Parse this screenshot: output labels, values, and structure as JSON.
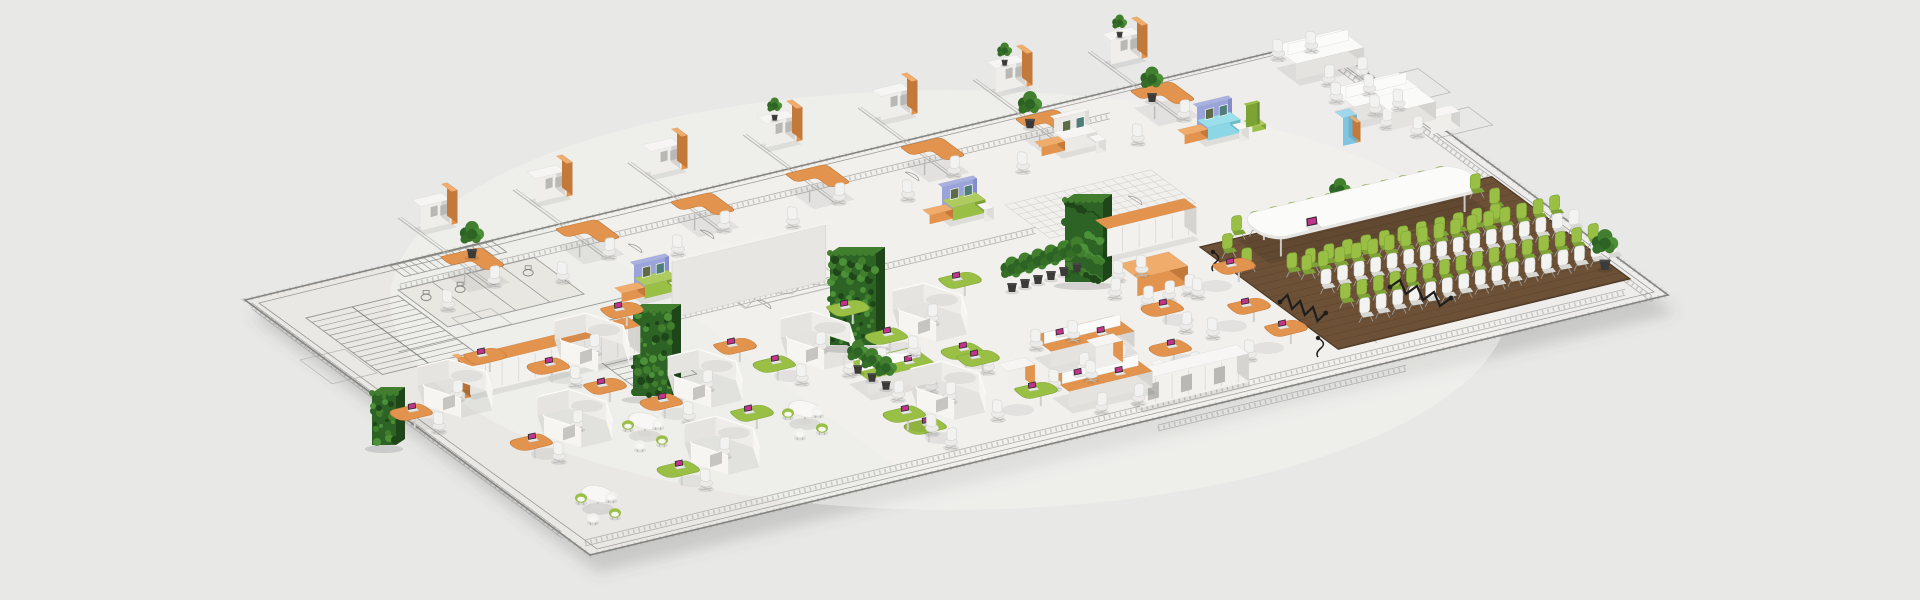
{
  "colors": {
    "bg": "#e8e8e7",
    "floorMain": "#eeedeb",
    "floorWing": "#e9e8e5",
    "centerLight": "#f4f3f0",
    "line": "#9a9a98",
    "lineDark": "#83837f",
    "lineFaint": "#bcbbb8",
    "orange": "#e2934e",
    "orangeLight": "#f0ac6b",
    "orangeDark": "#c3793a",
    "green": "#9abf45",
    "greenLight": "#aecb5f",
    "greenDark": "#7da336",
    "hedge": "#2d6324",
    "hedgeLight": "#417f2e",
    "hedgeDark": "#1e4619",
    "cyan": "#8bd7e5",
    "cyanDark": "#6cbccb",
    "lavender": "#9ba4da",
    "lavenderDark": "#848dc9",
    "wood": "#6d5137",
    "woodLine": "#55402a",
    "woodLight": "#7c5e41",
    "white": "#f5f4f2",
    "whiteFace": "#e4e3e0",
    "whiteSide": "#d5d4d1",
    "chairWhite": "#f2f2f0",
    "chairWhiteDark": "#d8d8d5",
    "screen": "#c2348c",
    "cable": "#1e1e1e",
    "shadow": "rgba(60,60,60,0.12)"
  },
  "areas": {
    "left_wing": "unfurnished-architectural-plan",
    "office_row": "private-offices",
    "bench_area": "open-bench-desks",
    "lounge": "soft-seating-lounge",
    "hex_field": "honeycomb-workstations",
    "conference": "town-hall-conference-area",
    "green_walls": "living-plant-walls"
  },
  "outline": {
    "corners": [
      [
        245,
        300
      ],
      [
        1323,
        40
      ],
      [
        1668,
        295
      ],
      [
        590,
        555
      ]
    ]
  },
  "offices": {
    "count": 7,
    "modules": [
      [
        412,
        224
      ],
      [
        527,
        196
      ],
      [
        642,
        169
      ],
      [
        757,
        141
      ],
      [
        872,
        114
      ],
      [
        987,
        86
      ],
      [
        1102,
        58
      ]
    ],
    "cabinet_plants": [
      3,
      5,
      6
    ],
    "floor_plants": [
      [
        472,
        252
      ],
      [
        1030,
        122
      ]
    ]
  },
  "benches": {
    "white_clusters": [
      [
        1272,
        62
      ],
      [
        1330,
        105
      ]
    ],
    "credenza": [
      1422,
      128
    ],
    "blue_locker": [
      1335,
      140
    ],
    "ne_meeting": [
      1372,
      116
    ]
  },
  "lounges": [
    {
      "x": 630,
      "y": 288,
      "sofa": "green"
    },
    {
      "x": 938,
      "y": 210,
      "sofa": "green"
    },
    {
      "x": 1050,
      "y": 142,
      "sofa": "white"
    },
    {
      "x": 1193,
      "y": 130,
      "sofa": "cyan"
    }
  ],
  "green_walls": [
    [
      633,
      310,
      39,
      86
    ],
    [
      830,
      253,
      46,
      92
    ],
    [
      1065,
      200,
      38,
      82
    ],
    [
      372,
      393,
      24,
      52
    ]
  ],
  "white_wall": [
    672,
    318,
    158,
    56
  ],
  "plant_row": {
    "start": [
      1012,
      286
    ],
    "step": [
      13,
      -4
    ],
    "count": 6
  },
  "plant_cluster": [
    [
      858,
      368
    ],
    [
      872,
      376
    ],
    [
      886,
      384
    ]
  ],
  "single_plants": [
    [
      472,
      252
    ],
    [
      1030,
      122
    ],
    [
      1152,
      96
    ],
    [
      1340,
      206
    ],
    [
      1605,
      263
    ]
  ],
  "cabinet_rows": [
    {
      "x": 458,
      "y": 386,
      "len": 175,
      "top": "orange"
    },
    {
      "x": 1095,
      "y": 248,
      "len": 92,
      "top": "orange"
    },
    {
      "x": 1128,
      "y": 399,
      "len": 112,
      "top": "white"
    }
  ],
  "hex_clusters": [
    {
      "x": 455,
      "y": 398,
      "c": "o"
    },
    {
      "x": 575,
      "y": 428,
      "c": "o"
    },
    {
      "x": 592,
      "y": 352,
      "c": "o"
    },
    {
      "x": 705,
      "y": 388,
      "c": "o"
    },
    {
      "x": 722,
      "y": 455,
      "c": "g"
    },
    {
      "x": 818,
      "y": 350,
      "c": "g"
    },
    {
      "x": 930,
      "y": 322,
      "c": "g"
    },
    {
      "x": 948,
      "y": 400,
      "c": "g"
    }
  ],
  "round_lounges": [
    [
      645,
      432
    ],
    [
      598,
      505
    ],
    [
      805,
      420
    ]
  ],
  "mobile_desks": [
    [
      935,
      430
    ],
    [
      1012,
      402
    ],
    [
      972,
      355
    ]
  ],
  "green_bench": [
    845,
    378
  ],
  "orange_benches": [
    [
      1030,
      352
    ],
    [
      1048,
      392
    ]
  ],
  "bench_cabinets": [
    [
      998,
      386
    ],
    [
      1086,
      362
    ]
  ],
  "transition": {
    "meeting_table": [
      1118,
      282
    ],
    "desks": [
      [
        1210,
        278
      ],
      [
        1172,
        312
      ],
      [
        1225,
        318
      ],
      [
        1180,
        352
      ],
      [
        1262,
        340
      ]
    ],
    "stools": [
      [
        1168,
        390
      ],
      [
        1150,
        372
      ]
    ]
  },
  "conference": {
    "wood": [
      1200,
      247,
      300,
      172
    ],
    "table": [
      1238,
      240,
      225,
      40
    ],
    "laptop": [
      1312,
      226
    ],
    "table_chairs_per_side": 12,
    "audience": {
      "a_start": 60,
      "b_start": 62,
      "a_step": 17,
      "b_step": 24,
      "rows": [
        "green",
        "white",
        "green",
        "white"
      ],
      "per_row": 16
    }
  }
}
